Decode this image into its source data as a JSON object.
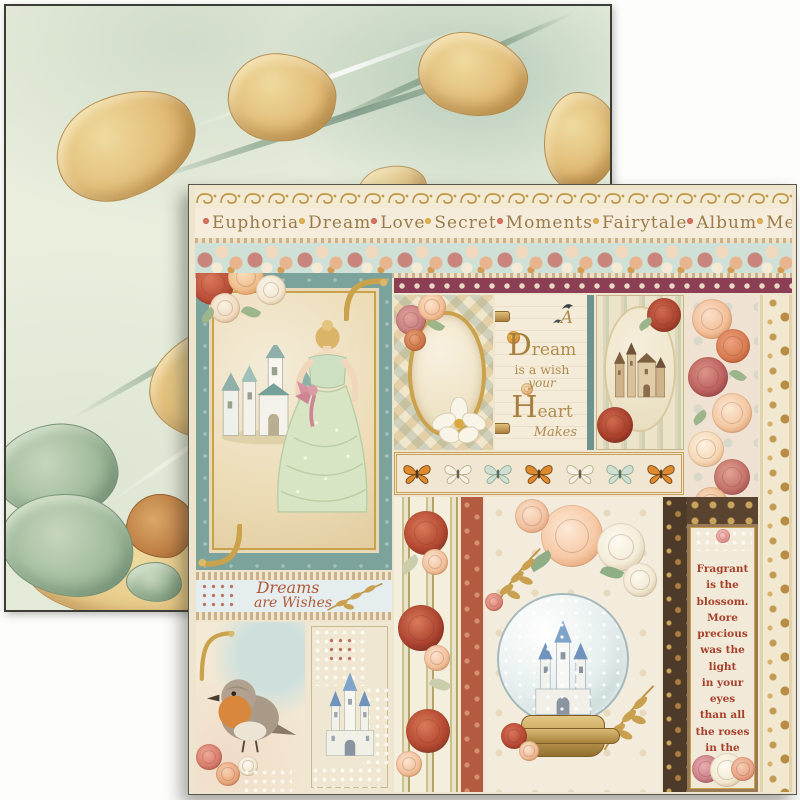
{
  "product": {
    "description": "Two overlapping decorative scrapbook paper sheets",
    "back_sheet_style": "green and gold marbled paper",
    "front_sheet_style": "fairytale collage paper with castles, princess, roses and verses"
  },
  "front_sheet": {
    "banner": {
      "words": [
        "Euphoria",
        "Dream",
        "Love",
        "Secret",
        "Moments",
        "Fairytale",
        "Album",
        "Memories"
      ]
    },
    "dream_quote": {
      "lines": [
        "A",
        "Dream",
        "is a wish",
        "your",
        "Heart",
        "Makes"
      ]
    },
    "dreams_label": {
      "line1": "Dreams",
      "line2": "are Wishes"
    },
    "verse": {
      "lines": [
        "Fragrant",
        "is the",
        "blossom.",
        "More",
        "precious",
        "was the light",
        "in your eyes",
        "than all",
        "the roses",
        "in the world"
      ]
    }
  },
  "palette": {
    "teal_panel": "#7ca29c",
    "maroon_strip": "#8c3e54",
    "gold_ornament": "#c9a24b",
    "rust_rose": "#b5543f",
    "cream": "#f2e9d8",
    "sage_marble": "#a3bc9d",
    "marble_gold": "#e0b66e",
    "verse_red": "#a8402c",
    "pale_blue": "#e6edee"
  },
  "decorative_elements": [
    "marbled-paper-sheet",
    "gold-scroll-border",
    "rose-garland-strip",
    "maroon-diamond-strip",
    "princess-with-castle-illustration",
    "oval-mirror-with-roses",
    "storybook-quote-page",
    "sepia-castle-vignette",
    "rose-border-column",
    "gold-damask-border",
    "butterfly-border-strip",
    "striped-rose-wallpaper",
    "snow-globe-castle",
    "robin-bird-illustration",
    "white-castle-illustration",
    "verse-bookmark-panel"
  ]
}
